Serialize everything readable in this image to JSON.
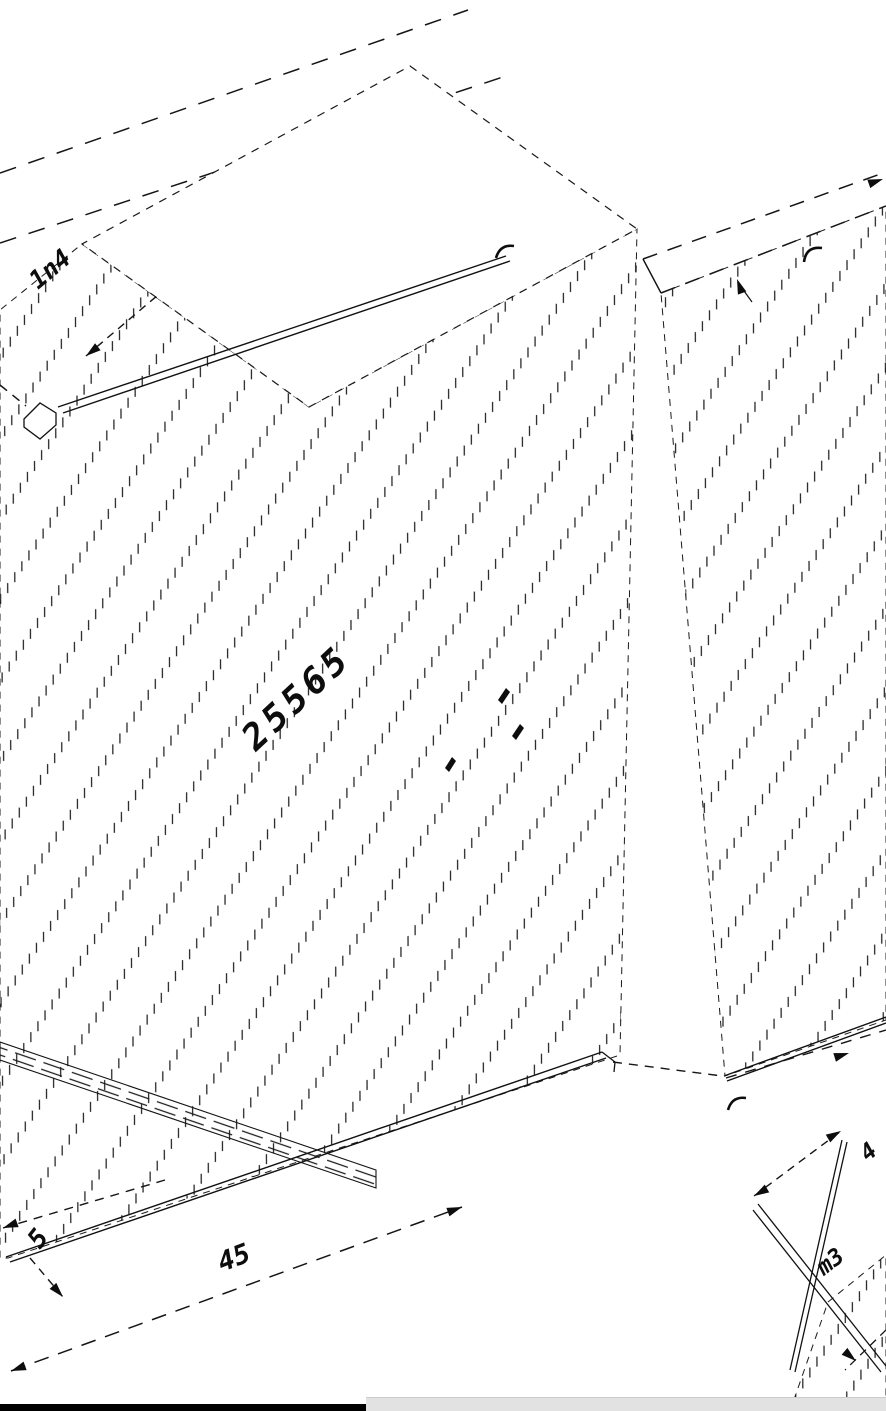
{
  "page": {
    "background": "#ffffff",
    "ink": "#111111",
    "kind": "isometric construction CAD drawing with hatched panels, phantom dashed outlines and oblique dimension labels"
  },
  "drawing": {
    "labels": {
      "upper_left": "1n4",
      "center": "25565",
      "bottom_dim": "45",
      "bottom_left_small": "5",
      "left_edge_clipped": "0",
      "bottom_right": "m3",
      "right_edge_clipped": "4"
    }
  },
  "viewer": {
    "scrollbar_color": "#e2e2e2",
    "bottom_border_color": "#000000"
  }
}
